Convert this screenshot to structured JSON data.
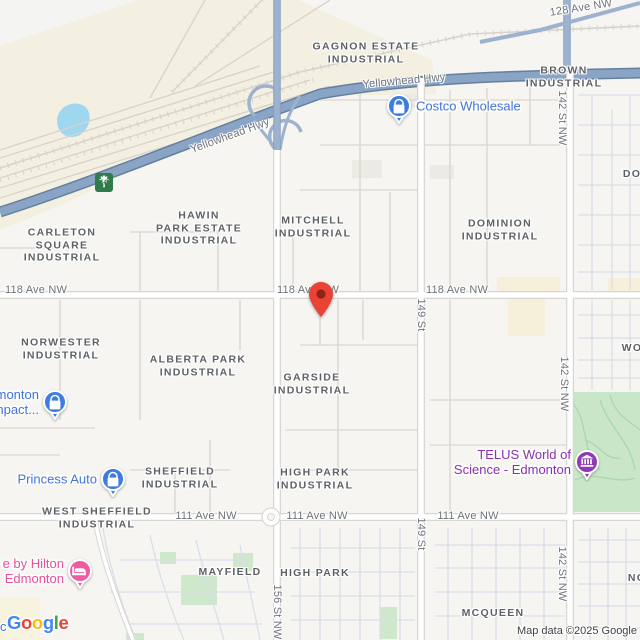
{
  "map": {
    "attribution": "Map data ©2025 Google",
    "logo": {
      "word": "Google",
      "letters": [
        {
          "ch": "G",
          "color": "#4285F4"
        },
        {
          "ch": "o",
          "color": "#EA4335"
        },
        {
          "ch": "o",
          "color": "#FBBC05"
        },
        {
          "ch": "g",
          "color": "#4285F4"
        },
        {
          "ch": "l",
          "color": "#34A853"
        },
        {
          "ch": "e",
          "color": "#EA4335"
        }
      ]
    },
    "highway_shield": {
      "number": "16",
      "color": "#2F7B4C"
    },
    "marker": {
      "name": "destination-pin",
      "color": "#EA4335",
      "dot_color": "#8E2418",
      "x": 321,
      "y": 317
    },
    "palette": {
      "industrial_beige": "#f3efe1",
      "commercial_yellow": "#f6efd9",
      "water_blue": "#9fd7f1",
      "park_green": "#c9e7c8",
      "highway_blue": "#8aa4c5",
      "poi_blue": "#3D7DE3",
      "poi_blue_text": "#4274DB",
      "poi_pink": "#EF5BA0",
      "poi_pink_text": "#E8519C",
      "poi_purple": "#8F3AB5",
      "poi_purple_text": "#8A2FB0"
    },
    "area_labels": [
      {
        "lines": [
          "GAGNON ESTATE",
          "INDUSTRIAL"
        ],
        "x": 366,
        "y": 53
      },
      {
        "lines": [
          "BROWN",
          "INDUSTRIAL"
        ],
        "x": 564,
        "y": 77
      },
      {
        "lines": [
          "DOMINION",
          "INDUSTRIAL"
        ],
        "x": 500,
        "y": 230
      },
      {
        "lines": [
          "HAWIN",
          "PARK ESTATE",
          "INDUSTRIAL"
        ],
        "x": 199,
        "y": 228
      },
      {
        "lines": [
          "MITCHELL",
          "INDUSTRIAL"
        ],
        "x": 313,
        "y": 227
      },
      {
        "lines": [
          "CARLETON",
          "SQUARE",
          "INDUSTRIAL"
        ],
        "x": 62,
        "y": 245
      },
      {
        "lines": [
          "NORWESTER",
          "INDUSTRIAL"
        ],
        "x": 61,
        "y": 349
      },
      {
        "lines": [
          "ALBERTA PARK",
          "INDUSTRIAL"
        ],
        "x": 198,
        "y": 366
      },
      {
        "lines": [
          "GARSIDE",
          "INDUSTRIAL"
        ],
        "x": 312,
        "y": 384
      },
      {
        "lines": [
          "SHEFFIELD",
          "INDUSTRIAL"
        ],
        "x": 180,
        "y": 478
      },
      {
        "lines": [
          "WEST SHEFFIELD",
          "INDUSTRIAL"
        ],
        "x": 97,
        "y": 518
      },
      {
        "lines": [
          "HIGH PARK",
          "INDUSTRIAL"
        ],
        "x": 315,
        "y": 479
      },
      {
        "lines": [
          "MAYFIELD"
        ],
        "x": 230,
        "y": 572
      },
      {
        "lines": [
          "HIGH PARK"
        ],
        "x": 315,
        "y": 573
      },
      {
        "lines": [
          "MCQUEEN"
        ],
        "x": 493,
        "y": 613
      },
      {
        "lines": [
          "DO"
        ],
        "x": 632,
        "y": 174
      },
      {
        "lines": [
          "WO"
        ],
        "x": 632,
        "y": 348
      },
      {
        "lines": [
          "NO"
        ],
        "x": 637,
        "y": 578
      }
    ],
    "street_labels": [
      {
        "text": "128 Ave NW",
        "x": 581,
        "y": 8,
        "rot": -9
      },
      {
        "text": "Yellowhead Hwy",
        "x": 230,
        "y": 136,
        "rot": -20
      },
      {
        "text": "Yellowhead Hwy",
        "x": 404,
        "y": 81,
        "rot": -5
      },
      {
        "text": "118 Ave NW",
        "x": 36,
        "y": 290,
        "rot": 0
      },
      {
        "text": "118 Ave NW",
        "x": 308,
        "y": 290,
        "rot": 0
      },
      {
        "text": "118 Ave NW",
        "x": 457,
        "y": 290,
        "rot": 0
      },
      {
        "text": "111 Ave NW",
        "x": 206,
        "y": 516,
        "rot": 0
      },
      {
        "text": "111 Ave NW",
        "x": 317,
        "y": 516,
        "rot": 0
      },
      {
        "text": "111 Ave NW",
        "x": 468,
        "y": 516,
        "rot": 0
      },
      {
        "text": "149 St",
        "x": 421,
        "y": 315,
        "rot": 90
      },
      {
        "text": "149 St",
        "x": 421,
        "y": 534,
        "rot": 90
      },
      {
        "text": "142 St NW",
        "x": 562,
        "y": 118,
        "rot": 90
      },
      {
        "text": "142 St NW",
        "x": 564,
        "y": 384,
        "rot": 90
      },
      {
        "text": "142 St NW",
        "x": 562,
        "y": 574,
        "rot": 90
      },
      {
        "text": "156 St NW",
        "x": 277,
        "y": 612,
        "rot": 90
      }
    ],
    "pois": [
      {
        "id": "costco",
        "lines": [
          "Costco Wholesale"
        ],
        "icon": "shopping-bag",
        "side": "right",
        "icon_color": "#3D7DE3",
        "text_color": "#4274DB",
        "x": 399,
        "y": 106
      },
      {
        "id": "edge-shopping",
        "lines": [
          "monton",
          "npact..."
        ],
        "icon": "shopping-bag",
        "side": "left",
        "icon_color": "#3D7DE3",
        "text_color": "#4274DB",
        "x": 55,
        "y": 402
      },
      {
        "id": "princess-auto",
        "lines": [
          "Princess Auto"
        ],
        "icon": "shopping-bag",
        "side": "left",
        "icon_color": "#3D7DE3",
        "text_color": "#4274DB",
        "x": 113,
        "y": 479
      },
      {
        "id": "hilton-hotel",
        "lines": [
          "e by Hilton",
          "Edmonton"
        ],
        "icon": "bed",
        "side": "left",
        "icon_color": "#EF5BA0",
        "text_color": "#E8519C",
        "x": 80,
        "y": 571
      },
      {
        "id": "telus-science",
        "lines": [
          "TELUS World of",
          "Science - Edmonton"
        ],
        "icon": "museum",
        "side": "left",
        "icon_color": "#8F3AB5",
        "text_color": "#8A2FB0",
        "x": 587,
        "y": 462
      }
    ],
    "edge_fragments": [
      {
        "text": "c",
        "x": 0,
        "y": 619,
        "color": "#4274DB"
      }
    ]
  }
}
